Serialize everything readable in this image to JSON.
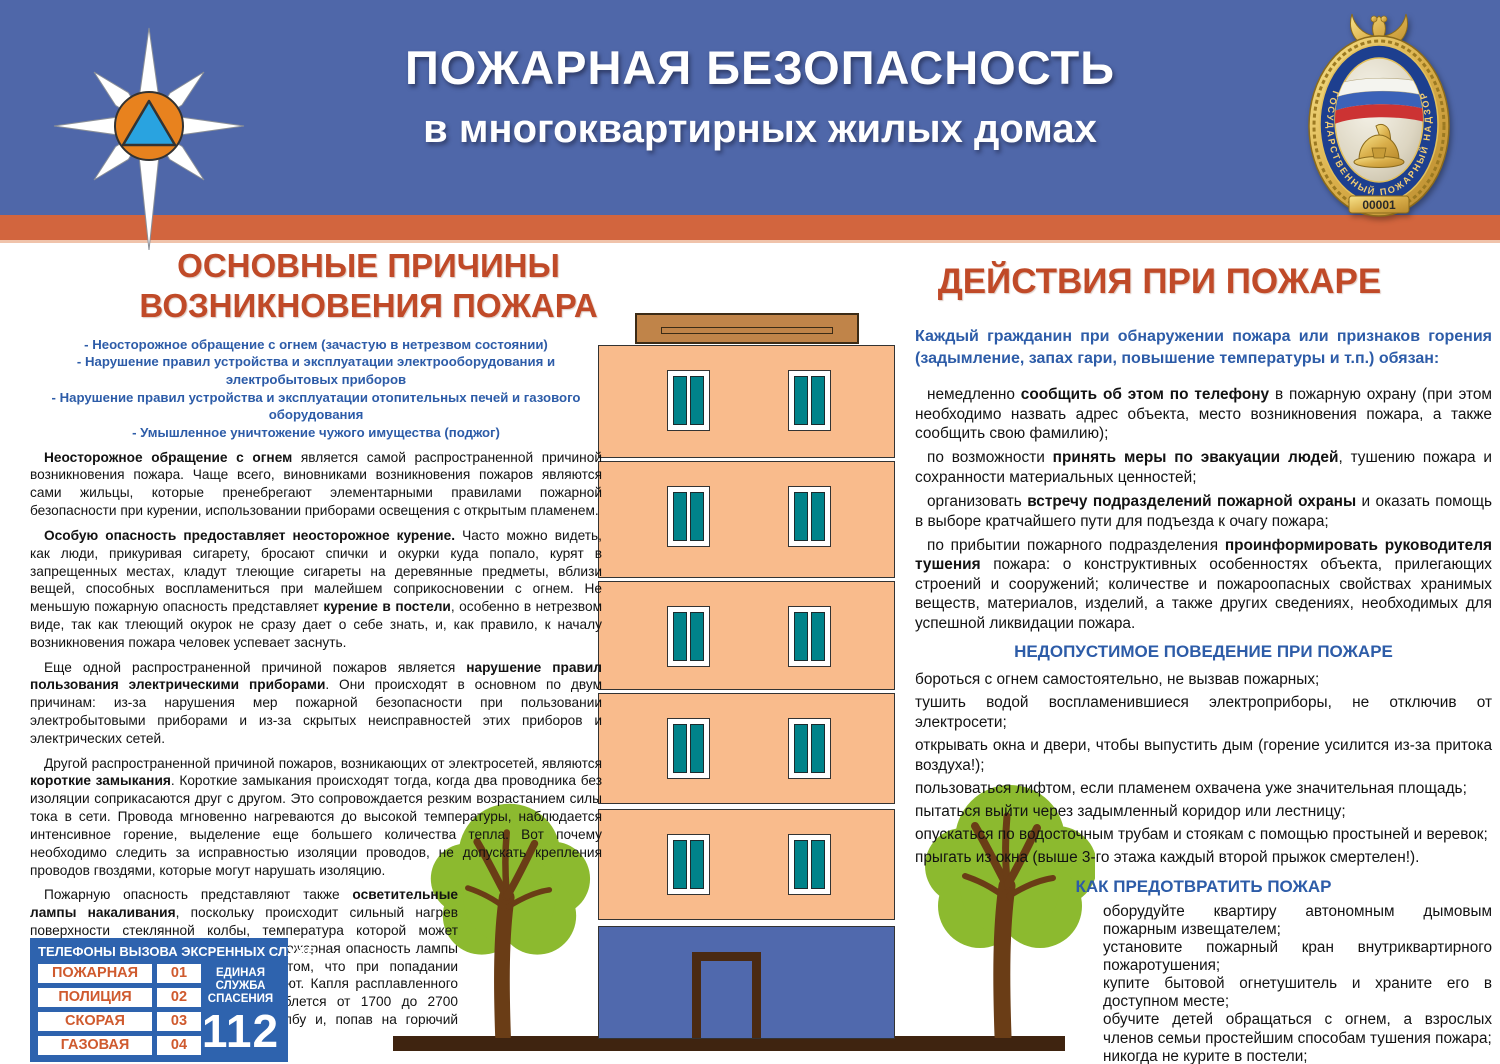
{
  "palette": {
    "header_blue": "#4f67a9",
    "stripe_orange": "#d2653e",
    "accent_red": "#c04a28",
    "accent_blue": "#2d5ca8",
    "building_peach": "#f9bb8c",
    "window_teal": "#00838a",
    "roof_brown": "#c08449",
    "ground_brown": "#3f2410",
    "tree_green": "#8cba2f",
    "trunk_brown": "#6a3d16",
    "phone_box_blue": "#2e63ae",
    "phone_text_orange": "#cf5a2e"
  },
  "icons": {
    "mchs-star-icon": "eight-point white star with orange oval and blue triangle",
    "gpn-badge-icon": "gold state fire supervision badge",
    "tree-icon": "green tree clipart"
  },
  "header": {
    "title_line1": "ПОЖАРНАЯ БЕЗОПАСНОСТЬ",
    "title_line2": "в многоквартирных жилых домах",
    "badge": {
      "ring_text": "ГОСУДАРСТВЕННЫЙ ПОЖАРНЫЙ НАДЗОР",
      "number": "00001"
    }
  },
  "left": {
    "heading_line1": "ОСНОВНЫЕ ПРИЧИНЫ",
    "heading_line2": "ВОЗНИКНОВЕНИЯ ПОЖАРА",
    "causes": [
      "-  Неосторожное обращение с огнем (зачастую в нетрезвом состоянии)",
      "- Нарушение правил устройства и эксплуатации электрооборудования и электробытовых приборов",
      "- Нарушение правил устройства и эксплуатации отопительных печей и газового оборудования",
      "- Умышленное уничтожение чужого имущества (поджог)"
    ],
    "p1": [
      {
        "b": true,
        "t": "Неосторожное обращение с огнем "
      },
      {
        "t": "является самой распространенной причиной возникновения пожара. Чаще всего, виновниками возникновения пожаров являются сами жильцы, которые пренебрегают элементарными правилами пожарной безопасности при курении, использовании приборами освещения с открытым пламенем."
      }
    ],
    "p2": [
      {
        "b": true,
        "t": "Особую опасность предоставляет неосторожное курение."
      },
      {
        "t": " Часто можно видеть, как люди, прикуривая сигарету, бросают спички и окурки куда попало, курят в запрещенных местах, кладут тлеющие сигареты на деревянные предметы, вблизи вещей, способных воспламениться при малейшем соприкосновении с огнем. Не меньшую пожарную опасность представляет "
      },
      {
        "b": true,
        "t": "курение в постели"
      },
      {
        "t": ", особенно в нетрезвом виде, так как тлеющий окурок не сразу дает о себе знать, и, как правило, к началу возникновения пожара человек успевает заснуть."
      }
    ],
    "p3": [
      {
        "t": "Еще одной распространенной причиной пожаров является "
      },
      {
        "b": true,
        "t": "нарушение правил пользования электрическими приборами"
      },
      {
        "t": ". Они происходят в основном по двум причинам: из-за нарушения мер пожарной безопасности при пользовании электробытовыми приборами и из-за скрытых неисправностей этих приборов и электрических сетей."
      }
    ],
    "p4": [
      {
        "t": "Другой распространенной причиной пожаров, возникающих от электросетей, являются "
      },
      {
        "b": true,
        "t": "короткие замыкания"
      },
      {
        "t": ". Короткие замыкания происходят тогда, когда два проводника без изоляции соприкасаются друг с другом. Это сопровождается резким возрастанием силы тока в сети. Провода мгновенно нагреваются до высокой температуры, наблюдается интенсивное горение, выделение еще большего количества тепла. Вот почему необходимо следить за исправностью изоляции проводов, не допускать крепления проводов гвоздями, которые могут нарушать изоляцию."
      }
    ],
    "p5": [
      {
        "t": "Пожарную опасность представляют также "
      },
      {
        "b": true,
        "t": "осветительные лампы накаливания"
      },
      {
        "t": ", поскольку происходит сильный нагрев поверхности стеклянной колбы, температура которой может достигать 500 градусов. Повышенная пожарная опасность лампы накаливания заключается еще и в том, что при попадании металлические нити спирали перегорают. Капля расплавленного металла, температура которого колеблется от 1700 до 2700 градусов цельсия, может прожечь колбу и, попав на горючий материал, вызвать его возгорание."
      }
    ]
  },
  "right": {
    "heading": "ДЕЙСТВИЯ ПРИ ПОЖАРЕ",
    "intro": "Каждый гражданин при обнаружении пожара или признаков горения (задымление, запах гари, повышение температуры и т.п.) обязан:",
    "p1": [
      {
        "t": "немедленно "
      },
      {
        "b": true,
        "t": "сообщить об этом по телефону"
      },
      {
        "t": " в пожарную охрану (при этом необходимо назвать адрес объекта, место возникновения пожара, а также сообщить свою фамилию);"
      }
    ],
    "p2": [
      {
        "t": "по возможности "
      },
      {
        "b": true,
        "t": "принять меры по эвакуации людей"
      },
      {
        "t": ", тушению пожара и сохранности материальных ценностей;"
      }
    ],
    "p3": [
      {
        "t": "организовать "
      },
      {
        "b": true,
        "t": "встречу подразделений пожарной охраны"
      },
      {
        "t": " и оказать помощь в выборе кратчайшего пути для подъезда к очагу пожара;"
      }
    ],
    "p4": [
      {
        "t": "по прибытии пожарного подразделения "
      },
      {
        "b": true,
        "t": "проинформировать руководителя тушения"
      },
      {
        "t": " пожара: о  конструктивных особенностях объекта, прилегающих строений и сооружений; количестве и пожароопасных свойствах хранимых веществ, материалов, изделий, а также других сведениях, необходимых для успешной ликвидации пожара."
      }
    ],
    "sub1": "НЕДОПУСТИМОЕ ПОВЕДЕНИЕ ПРИ ПОЖАРЕ",
    "forbidden": [
      "бороться с огнем самостоятельно, не вызвав пожарных;",
      "тушить водой воспламенившиеся электроприборы, не отключив от электросети;",
      "открывать окна и двери, чтобы выпустить дым (горение усилится из-за притока воздуха!);",
      "пользоваться лифтом, если пламенем охвачена уже значительная площадь;",
      "пытаться выйти через задымленный коридор или лестницу;",
      "опускаться по водосточным трубам и стоякам с помощью простыней и веревок;",
      "прыгать из окна (выше 3-го этажа каждый второй прыжок смертелен!)."
    ],
    "sub2": "КАК ПРЕДОТВРАТИТЬ ПОЖАР",
    "prevent": [
      "оборудуйте квартиру автономным дымовым пожарным извещателем;",
      "установите пожарный кран внутриквартирного пожаротушения;",
      "купите бытовой огнетушитель и храните его в доступном месте;",
      "обучите детей обращаться с огнем, а взрослых членов семьи простейшим способам тушения пожара;",
      "никогда не курите в постели;",
      "не оставляйте без присмотра электробытовые приборы."
    ]
  },
  "phones": {
    "title": "ТЕЛЕФОНЫ ВЫЗОВА ЭКСРЕННЫХ СЛУЖБ",
    "rows": [
      {
        "name": "ПОЖАРНАЯ",
        "num": "01"
      },
      {
        "name": "ПОЛИЦИЯ",
        "num": "02"
      },
      {
        "name": "СКОРАЯ",
        "num": "03"
      },
      {
        "name": "ГАЗОВАЯ",
        "num": "04"
      }
    ],
    "single_line1": "ЕДИНАЯ СЛУЖБА",
    "single_line2": "СПАСЕНИЯ",
    "single_number": "112"
  }
}
